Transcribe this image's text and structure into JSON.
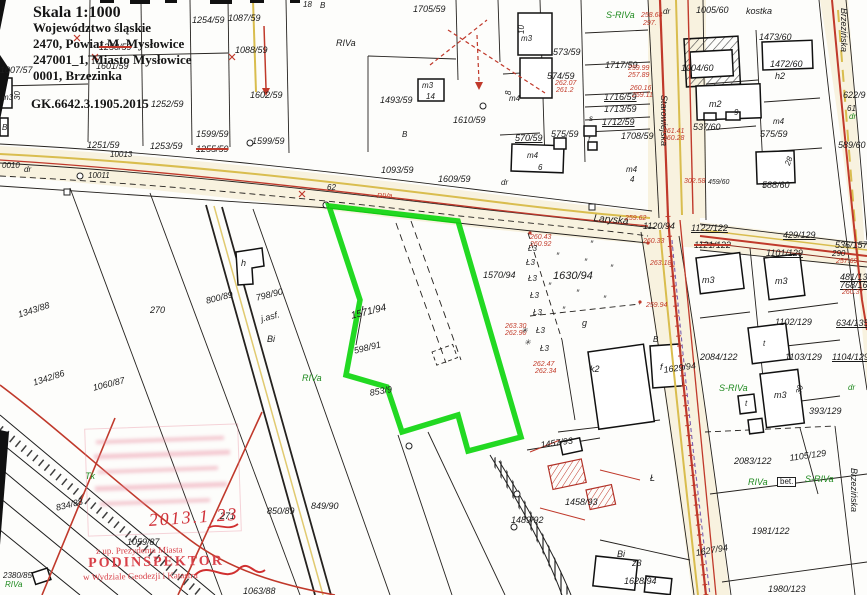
{
  "header": {
    "scale": "Skala 1:1000",
    "line1": "Województwo śląskie",
    "line2": "2470, Powiat M. Mysłowice",
    "line3": "247001_1, Miasto Mysłowice",
    "line4": "0001, Brzezinka",
    "doc_no": "GK.6642.3.1905.2015"
  },
  "stamp": {
    "line1": "z up. Prezydenta Miasta",
    "name": "PODINSPEKTOR",
    "line2": "w Wydziale Geodezji i Katastru",
    "date": "2013.1.23"
  },
  "colors": {
    "highlight": "#0fd60f",
    "red_ink": "#c0392b",
    "utility_yellow": "#d9bd4e",
    "stamp_red": "#d84048",
    "veg_green": "#1f8a1f"
  },
  "highlighted_parcel": "1571/94",
  "map": {
    "labels": [
      {
        "t": "1254/59",
        "x": 192,
        "y": 16
      },
      {
        "t": "1087/59",
        "x": 228,
        "y": 14
      },
      {
        "t": "1088/59",
        "x": 235,
        "y": 46
      },
      {
        "t": "1250/59",
        "x": 99,
        "y": 43,
        "k": 1
      },
      {
        "t": "1601/59",
        "x": 96,
        "y": 62
      },
      {
        "t": "1602/59",
        "x": 250,
        "y": 91
      },
      {
        "t": "1252/59",
        "x": 151,
        "y": 100
      },
      {
        "t": "1599/59",
        "x": 196,
        "y": 130
      },
      {
        "t": "1255/59",
        "x": 196,
        "y": 145,
        "k": 1
      },
      {
        "t": "1599/59",
        "x": 252,
        "y": 137
      },
      {
        "t": "1251/59",
        "x": 87,
        "y": 141
      },
      {
        "t": "10013",
        "x": 110,
        "y": 151,
        "s": 8
      },
      {
        "t": "1253/59",
        "x": 150,
        "y": 142
      },
      {
        "t": "0010",
        "x": 2,
        "y": 162,
        "s": 8
      },
      {
        "t": "dr",
        "x": 24,
        "y": 166,
        "s": 8
      },
      {
        "t": "10011",
        "x": 88,
        "y": 172,
        "s": 8
      },
      {
        "t": "1007/57",
        "x": 0,
        "y": 66
      },
      {
        "t": "m3",
        "x": 2,
        "y": 94,
        "s": 8
      },
      {
        "t": "30",
        "x": 14,
        "y": 100,
        "s": 8,
        "r": -90
      },
      {
        "t": "B",
        "x": 2,
        "y": 124,
        "s": 8
      },
      {
        "t": "18",
        "x": 303,
        "y": 1,
        "s": 8
      },
      {
        "t": "B",
        "x": 320,
        "y": 2,
        "s": 8
      },
      {
        "t": "1705/59",
        "x": 413,
        "y": 5
      },
      {
        "t": "RIVa",
        "x": 336,
        "y": 39
      },
      {
        "t": "1493/59",
        "x": 380,
        "y": 96
      },
      {
        "t": "B",
        "x": 402,
        "y": 131,
        "s": 8
      },
      {
        "t": "1610/59",
        "x": 453,
        "y": 116
      },
      {
        "t": "m3",
        "x": 422,
        "y": 82,
        "s": 8
      },
      {
        "t": "14",
        "x": 426,
        "y": 93,
        "s": 8
      },
      {
        "t": "62",
        "x": 327,
        "y": 184,
        "s": 8
      },
      {
        "t": "RIVa",
        "x": 377,
        "y": 193,
        "c": "#c23b2a",
        "s": 7
      },
      {
        "t": "1093/59",
        "x": 381,
        "y": 166
      },
      {
        "t": "1609/59",
        "x": 438,
        "y": 175
      },
      {
        "t": "dr",
        "x": 501,
        "y": 179,
        "s": 8
      },
      {
        "t": "Laryska",
        "x": 594,
        "y": 214,
        "s": 10,
        "r": 5
      },
      {
        "t": "570/59",
        "x": 515,
        "y": 134,
        "u": 1
      },
      {
        "t": "575/59",
        "x": 551,
        "y": 130
      },
      {
        "t": "m4",
        "x": 527,
        "y": 152,
        "s": 8
      },
      {
        "t": "6",
        "x": 538,
        "y": 164,
        "s": 8
      },
      {
        "t": "m4",
        "x": 626,
        "y": 166,
        "s": 8
      },
      {
        "t": "4",
        "x": 630,
        "y": 176,
        "s": 8
      },
      {
        "t": "1708/59",
        "x": 621,
        "y": 132
      },
      {
        "t": "573/59",
        "x": 553,
        "y": 48
      },
      {
        "t": "10",
        "x": 518,
        "y": 34,
        "s": 8,
        "r": -90
      },
      {
        "t": "m3",
        "x": 521,
        "y": 35,
        "s": 8
      },
      {
        "t": "574/59",
        "x": 547,
        "y": 72
      },
      {
        "t": "262.07",
        "x": 555,
        "y": 80,
        "c": "#c23b2a",
        "s": 7
      },
      {
        "t": "261.2",
        "x": 556,
        "y": 87,
        "c": "#c23b2a",
        "s": 7
      },
      {
        "t": "8",
        "x": 505,
        "y": 95,
        "s": 8,
        "r": -90
      },
      {
        "t": "m4",
        "x": 509,
        "y": 95,
        "s": 8
      },
      {
        "t": "s",
        "x": 589,
        "y": 115,
        "s": 8
      },
      {
        "t": "t",
        "x": 588,
        "y": 136,
        "s": 8
      },
      {
        "t": "1717/59",
        "x": 605,
        "y": 61
      },
      {
        "t": "259.99",
        "x": 628,
        "y": 65,
        "c": "#c23b2a",
        "s": 7
      },
      {
        "t": "257.89",
        "x": 628,
        "y": 72,
        "c": "#c23b2a",
        "s": 7
      },
      {
        "t": "1716/59",
        "x": 604,
        "y": 93,
        "u": 1
      },
      {
        "t": "260.16",
        "x": 630,
        "y": 85,
        "c": "#c23b2a",
        "s": 7
      },
      {
        "t": "259.11",
        "x": 632,
        "y": 92,
        "c": "#c23b2a",
        "s": 7
      },
      {
        "t": "1713/59",
        "x": 604,
        "y": 105
      },
      {
        "t": "1712/59",
        "x": 602,
        "y": 118,
        "u": 1
      },
      {
        "t": "S-RIVa",
        "x": 606,
        "y": 11,
        "c": "#1f8a1f"
      },
      {
        "t": "258.68",
        "x": 641,
        "y": 12,
        "c": "#c23b2a",
        "s": 7
      },
      {
        "t": "297.",
        "x": 643,
        "y": 20,
        "c": "#c23b2a",
        "s": 7
      },
      {
        "t": "dr",
        "x": 663,
        "y": 8,
        "s": 8
      },
      {
        "t": "1005/60",
        "x": 696,
        "y": 6
      },
      {
        "t": "kostka",
        "x": 746,
        "y": 7
      },
      {
        "t": "1473/60",
        "x": 759,
        "y": 33
      },
      {
        "t": "Brzezińska",
        "x": 848,
        "y": 8,
        "v": 1
      },
      {
        "t": "1004/60",
        "x": 681,
        "y": 64
      },
      {
        "t": "m2",
        "x": 709,
        "y": 100
      },
      {
        "t": "9",
        "x": 734,
        "y": 109,
        "s": 8
      },
      {
        "t": "537/60",
        "x": 693,
        "y": 123
      },
      {
        "t": "1472/60",
        "x": 770,
        "y": 60
      },
      {
        "t": "h2",
        "x": 775,
        "y": 72
      },
      {
        "t": "622/9",
        "x": 843,
        "y": 91
      },
      {
        "t": "61",
        "x": 847,
        "y": 105,
        "s": 8
      },
      {
        "t": "dr",
        "x": 849,
        "y": 113,
        "s": 8,
        "c": "#1f8a1f"
      },
      {
        "t": "m4",
        "x": 773,
        "y": 118,
        "s": 8
      },
      {
        "t": "575/59",
        "x": 760,
        "y": 130
      },
      {
        "t": "589/60",
        "x": 838,
        "y": 141
      },
      {
        "t": "588/60",
        "x": 762,
        "y": 181
      },
      {
        "t": "28",
        "x": 784,
        "y": 164,
        "s": 8,
        "r": -70
      },
      {
        "t": "302.58",
        "x": 684,
        "y": 178,
        "c": "#c23b2a",
        "s": 7
      },
      {
        "t": "459/60",
        "x": 708,
        "y": 179,
        "s": 7
      },
      {
        "t": "Starowiejska",
        "x": 668,
        "y": 95,
        "v": 1
      },
      {
        "t": "1120/94",
        "x": 643,
        "y": 222
      },
      {
        "t": "1122/122",
        "x": 691,
        "y": 224,
        "u": 1
      },
      {
        "t": "1121/122",
        "x": 694,
        "y": 241,
        "k": 1
      },
      {
        "t": "429/129",
        "x": 783,
        "y": 231,
        "u": 1
      },
      {
        "t": "1101/129",
        "x": 766,
        "y": 249,
        "u": 1
      },
      {
        "t": "536/157",
        "x": 835,
        "y": 241
      },
      {
        "t": "290",
        "x": 832,
        "y": 250,
        "s": 8
      },
      {
        "t": "257.69",
        "x": 836,
        "y": 258,
        "c": "#c23b2a",
        "s": 7
      },
      {
        "t": "481/135",
        "x": 840,
        "y": 273,
        "u": 1
      },
      {
        "t": "768/166",
        "x": 840,
        "y": 281,
        "u": 1
      },
      {
        "t": "260.37",
        "x": 842,
        "y": 289,
        "c": "#c23b2a",
        "s": 7
      },
      {
        "t": "261.41",
        "x": 663,
        "y": 128,
        "c": "#c23b2a",
        "s": 7
      },
      {
        "t": "260.28",
        "x": 663,
        "y": 135,
        "c": "#c23b2a",
        "s": 7
      },
      {
        "t": "1570/94",
        "x": 483,
        "y": 271
      },
      {
        "t": "1630/94",
        "x": 553,
        "y": 271,
        "s": 11
      },
      {
        "t": "g",
        "x": 582,
        "y": 319
      },
      {
        "t": "m3",
        "x": 702,
        "y": 276
      },
      {
        "t": "m3",
        "x": 775,
        "y": 277
      },
      {
        "t": "1102/129",
        "x": 775,
        "y": 318
      },
      {
        "t": "634/135",
        "x": 836,
        "y": 319,
        "u": 1
      },
      {
        "t": "2084/122",
        "x": 700,
        "y": 353
      },
      {
        "t": "1103/129",
        "x": 785,
        "y": 353
      },
      {
        "t": "1104/129",
        "x": 832,
        "y": 353,
        "u": 1
      },
      {
        "t": "S-RIVa",
        "x": 719,
        "y": 384,
        "c": "#1f8a1f"
      },
      {
        "t": "dr",
        "x": 848,
        "y": 384,
        "s": 8,
        "c": "#1f8a1f"
      },
      {
        "t": "393/129",
        "x": 809,
        "y": 407
      },
      {
        "t": "m3",
        "x": 774,
        "y": 391
      },
      {
        "t": "30",
        "x": 795,
        "y": 393,
        "s": 8,
        "r": -75
      },
      {
        "t": "1629/94",
        "x": 663,
        "y": 366,
        "r": -8
      },
      {
        "t": "t",
        "x": 763,
        "y": 340,
        "s": 8
      },
      {
        "t": "t",
        "x": 745,
        "y": 400,
        "s": 8
      },
      {
        "t": "k2",
        "x": 590,
        "y": 365
      },
      {
        "t": "f",
        "x": 660,
        "y": 363
      },
      {
        "t": "B",
        "x": 653,
        "y": 336,
        "s": 8
      },
      {
        "t": "260.43",
        "x": 530,
        "y": 234,
        "c": "#c23b2a",
        "s": 7
      },
      {
        "t": "260.92",
        "x": 530,
        "y": 241,
        "c": "#c23b2a",
        "s": 7
      },
      {
        "t": "259.62",
        "x": 625,
        "y": 215,
        "c": "#c23b2a",
        "s": 7
      },
      {
        "t": "260.33",
        "x": 643,
        "y": 238,
        "c": "#c23b2a",
        "s": 7
      },
      {
        "t": "263.18",
        "x": 650,
        "y": 260,
        "c": "#c23b2a",
        "s": 7
      },
      {
        "t": "259.94",
        "x": 646,
        "y": 302,
        "c": "#c23b2a",
        "s": 7
      },
      {
        "t": "263.30",
        "x": 505,
        "y": 323,
        "c": "#c23b2a",
        "s": 7
      },
      {
        "t": "262.90",
        "x": 505,
        "y": 330,
        "c": "#c23b2a",
        "s": 7
      },
      {
        "t": "262.47",
        "x": 533,
        "y": 361,
        "c": "#c23b2a",
        "s": 7
      },
      {
        "t": "262.34",
        "x": 535,
        "y": 368,
        "c": "#c23b2a",
        "s": 7
      },
      {
        "t": "1571/94",
        "x": 350,
        "y": 312,
        "r": -14,
        "s": 10
      },
      {
        "t": "598/91",
        "x": 353,
        "y": 347,
        "r": -14
      },
      {
        "t": "853/9",
        "x": 369,
        "y": 389,
        "r": -10
      },
      {
        "t": "RIVa",
        "x": 302,
        "y": 374,
        "c": "#1f8a1f"
      },
      {
        "t": "1457/93",
        "x": 540,
        "y": 441,
        "r": -8
      },
      {
        "t": "1458/93",
        "x": 565,
        "y": 498
      },
      {
        "t": "1489/92",
        "x": 511,
        "y": 516
      },
      {
        "t": "849/90",
        "x": 311,
        "y": 502
      },
      {
        "t": "850/89",
        "x": 267,
        "y": 507
      },
      {
        "t": "800/89",
        "x": 205,
        "y": 297,
        "r": -14
      },
      {
        "t": "798/90",
        "x": 255,
        "y": 294,
        "r": -14
      },
      {
        "t": "j.asf.",
        "x": 260,
        "y": 315,
        "r": -14
      },
      {
        "t": "Bi",
        "x": 267,
        "y": 335
      },
      {
        "t": "270",
        "x": 150,
        "y": 306
      },
      {
        "t": "271",
        "x": 220,
        "y": 512
      },
      {
        "t": "1343/88",
        "x": 17,
        "y": 311,
        "r": -18
      },
      {
        "t": "1342/86",
        "x": 32,
        "y": 379,
        "r": -18
      },
      {
        "t": "1060/87",
        "x": 92,
        "y": 384,
        "r": -14
      },
      {
        "t": "1059/87",
        "x": 127,
        "y": 538
      },
      {
        "t": "834/88",
        "x": 55,
        "y": 504,
        "r": -14
      },
      {
        "t": "1063/88",
        "x": 243,
        "y": 587
      },
      {
        "t": "2380/85",
        "x": 3,
        "y": 572,
        "s": 8
      },
      {
        "t": "RIVa",
        "x": 5,
        "y": 581,
        "c": "#1f8a1f",
        "s": 8
      },
      {
        "t": "Tk",
        "x": 85,
        "y": 472,
        "c": "#1f8a1f"
      },
      {
        "t": "h",
        "x": 241,
        "y": 259
      },
      {
        "t": "Bi",
        "x": 617,
        "y": 550
      },
      {
        "t": "z3",
        "x": 632,
        "y": 559
      },
      {
        "t": "1628/94",
        "x": 624,
        "y": 577
      },
      {
        "t": "1627/94",
        "x": 695,
        "y": 549,
        "r": -10
      },
      {
        "t": "1980/123",
        "x": 768,
        "y": 585
      },
      {
        "t": "1981/122",
        "x": 752,
        "y": 527
      },
      {
        "t": "2083/122",
        "x": 734,
        "y": 457
      },
      {
        "t": "1105/129",
        "x": 789,
        "y": 454,
        "r": -8
      },
      {
        "t": "RIVa",
        "x": 748,
        "y": 478,
        "c": "#1f8a1f"
      },
      {
        "t": "bet.",
        "x": 777,
        "y": 477,
        "s": 8,
        "box": 1
      },
      {
        "t": "S-RIVa",
        "x": 805,
        "y": 475,
        "c": "#1f8a1f"
      },
      {
        "t": "Brzezińska",
        "x": 858,
        "y": 468,
        "v": 1
      },
      {
        "t": "Ł",
        "x": 650,
        "y": 474
      },
      {
        "t": "Ł3",
        "x": 528,
        "y": 245,
        "s": 8
      },
      {
        "t": "Ł3",
        "x": 526,
        "y": 259,
        "s": 8
      },
      {
        "t": "Ł3",
        "x": 528,
        "y": 275,
        "s": 8
      },
      {
        "t": "Ł3",
        "x": 530,
        "y": 292,
        "s": 8
      },
      {
        "t": "Ł3",
        "x": 533,
        "y": 309,
        "s": 8
      },
      {
        "t": "Ł3",
        "x": 536,
        "y": 327,
        "s": 8
      },
      {
        "t": "Ł3",
        "x": 540,
        "y": 345,
        "s": 8
      },
      {
        "t": "″",
        "x": 556,
        "y": 252,
        "s": 9,
        "c": "#333"
      },
      {
        "t": "″",
        "x": 584,
        "y": 258,
        "s": 9,
        "c": "#333"
      },
      {
        "t": "″",
        "x": 610,
        "y": 264,
        "s": 9,
        "c": "#333"
      },
      {
        "t": "″",
        "x": 548,
        "y": 282,
        "s": 9,
        "c": "#333"
      },
      {
        "t": "″",
        "x": 576,
        "y": 289,
        "s": 9,
        "c": "#333"
      },
      {
        "t": "″",
        "x": 603,
        "y": 295,
        "s": 9,
        "c": "#333"
      },
      {
        "t": "″",
        "x": 562,
        "y": 306,
        "s": 9,
        "c": "#333"
      },
      {
        "t": "″",
        "x": 590,
        "y": 240,
        "s": 9,
        "c": "#333"
      },
      {
        "t": "✳",
        "x": 521,
        "y": 327,
        "s": 8,
        "c": "#333"
      },
      {
        "t": "✳",
        "x": 524,
        "y": 339,
        "s": 8,
        "c": "#333"
      }
    ]
  }
}
